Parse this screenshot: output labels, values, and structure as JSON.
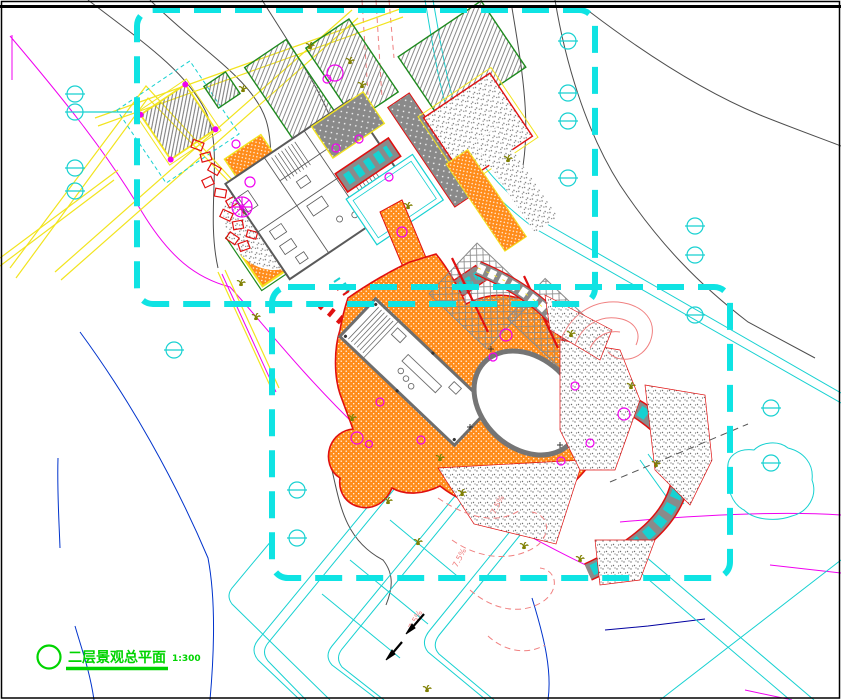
{
  "drawing": {
    "title": {
      "text": "二层景观总平面",
      "scale": "1:300"
    },
    "slope_labels": [
      "7.5%",
      "7.5%",
      "7.5%"
    ],
    "colors": {
      "boundary_cyan": "#0fe3e3",
      "road_yellow": "#f2e41f",
      "paving_orange": "#ff8c1a",
      "outline_red": "#e01010",
      "plan_gray": "#5a5a5a",
      "planting_green": "#1e8a1e",
      "title_green": "#00d400",
      "contour_magenta": "#f000f0",
      "contour_blue": "#0033cc",
      "contour_salmon": "#f08080",
      "water_cyan": "#17d1d1",
      "plant_olive": "#7f7f00"
    },
    "symbols": {
      "survey_marker": "circle-with-bar-icon",
      "shrub": "shrub-tuft-icon",
      "tree": "tree-circle-icon",
      "rockery": "rock-outline-icon",
      "slope_arrow": "slope-arrow-icon"
    }
  }
}
